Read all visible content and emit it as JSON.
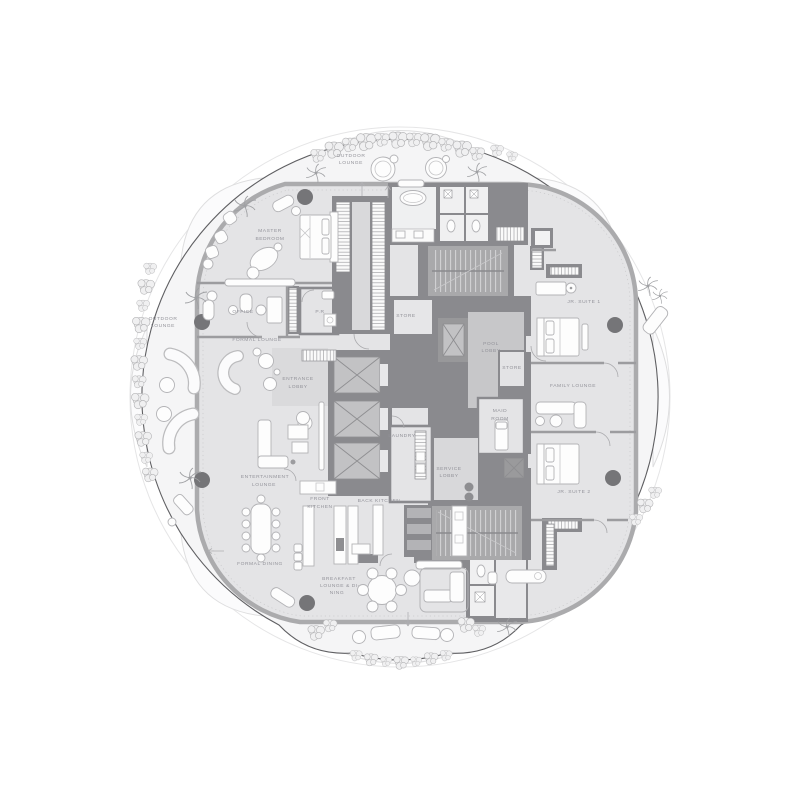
{
  "document": {
    "kind": "architectural-floor-plan",
    "shape": "circular residential tower plate",
    "palette": {
      "background": "#ffffff",
      "terrace": "#f5f5f6",
      "plate": "#e4e4e6",
      "core_wall": "#8a8a8e",
      "stair_fill": "#a9a9ab",
      "elevator_cab": "#c2c2c4",
      "pool_lobby": "#c7c7c9",
      "entrance_tint": "#dadadc",
      "label_text": "#93939a",
      "outline": "#5f5f62",
      "column": "#757578"
    }
  },
  "floorplan": {
    "labels": [
      {
        "id": "outdoor-lounge-top",
        "lines": [
          {
            "t": "OUTDOOR",
            "x": 351,
            "y": 157
          },
          {
            "t": "LOUNGE",
            "x": 351,
            "y": 164
          }
        ]
      },
      {
        "id": "master-bedroom",
        "lines": [
          {
            "t": "MASTER",
            "x": 270,
            "y": 232
          },
          {
            "t": "BEDROOM",
            "x": 270,
            "y": 240
          }
        ]
      },
      {
        "id": "office",
        "lines": [
          {
            "t": "OFFICE",
            "x": 243,
            "y": 313
          }
        ]
      },
      {
        "id": "powder-room",
        "lines": [
          {
            "t": "P.R",
            "x": 320,
            "y": 313
          }
        ]
      },
      {
        "id": "outdoor-lounge-left",
        "lines": [
          {
            "t": "OUTDOOR",
            "x": 163,
            "y": 320
          },
          {
            "t": "LOUNGE",
            "x": 163,
            "y": 327
          }
        ]
      },
      {
        "id": "formal-lounge",
        "lines": [
          {
            "t": "FORMAL LOUNGE",
            "x": 257,
            "y": 341
          }
        ]
      },
      {
        "id": "entrance-lobby",
        "lines": [
          {
            "t": "ENTRANCE",
            "x": 298,
            "y": 380
          },
          {
            "t": "LOBBY",
            "x": 298,
            "y": 388
          }
        ]
      },
      {
        "id": "store-upper",
        "lines": [
          {
            "t": "STORE",
            "x": 406,
            "y": 317
          }
        ]
      },
      {
        "id": "pool-lobby",
        "lines": [
          {
            "t": "POOL",
            "x": 491,
            "y": 345
          },
          {
            "t": "LOBBY",
            "x": 491,
            "y": 352
          }
        ]
      },
      {
        "id": "store-lower",
        "lines": [
          {
            "t": "STORE",
            "x": 512,
            "y": 369
          }
        ]
      },
      {
        "id": "jr-suite-1",
        "lines": [
          {
            "t": "JR. SUITE 1",
            "x": 584,
            "y": 303
          }
        ]
      },
      {
        "id": "family-lounge",
        "lines": [
          {
            "t": "FAMILY LOUNGE",
            "x": 573,
            "y": 387
          }
        ]
      },
      {
        "id": "maid-room",
        "lines": [
          {
            "t": "MAID",
            "x": 500,
            "y": 412
          },
          {
            "t": "ROOM",
            "x": 500,
            "y": 420
          }
        ]
      },
      {
        "id": "laundry",
        "lines": [
          {
            "t": "LAUNDRY",
            "x": 402,
            "y": 437
          }
        ]
      },
      {
        "id": "service-lobby",
        "lines": [
          {
            "t": "SERVICE",
            "x": 449,
            "y": 470
          },
          {
            "t": "LOBBY",
            "x": 449,
            "y": 477
          }
        ]
      },
      {
        "id": "entertainment-lounge",
        "lines": [
          {
            "t": "ENTERTAINMENT",
            "x": 265,
            "y": 478
          },
          {
            "t": "LOUNGE",
            "x": 264,
            "y": 486
          }
        ]
      },
      {
        "id": "jr-suite-2",
        "lines": [
          {
            "t": "JR. SUITE 2",
            "x": 574,
            "y": 493
          }
        ]
      },
      {
        "id": "front-kitchen",
        "lines": [
          {
            "t": "FRONT",
            "x": 320,
            "y": 500
          },
          {
            "t": "KITCHEN",
            "x": 320,
            "y": 508
          }
        ]
      },
      {
        "id": "back-kitchen",
        "lines": [
          {
            "t": "BACK KITCHEN",
            "x": 379,
            "y": 502
          }
        ]
      },
      {
        "id": "formal-dining",
        "lines": [
          {
            "t": "FORMAL DINING",
            "x": 260,
            "y": 565
          }
        ]
      },
      {
        "id": "breakfast-lounge-dining",
        "lines": [
          {
            "t": "BREAKFAST",
            "x": 339,
            "y": 580
          },
          {
            "t": "LOUNGE & DI-",
            "x": 340,
            "y": 587
          },
          {
            "t": "NING",
            "x": 337,
            "y": 594
          }
        ]
      }
    ]
  }
}
